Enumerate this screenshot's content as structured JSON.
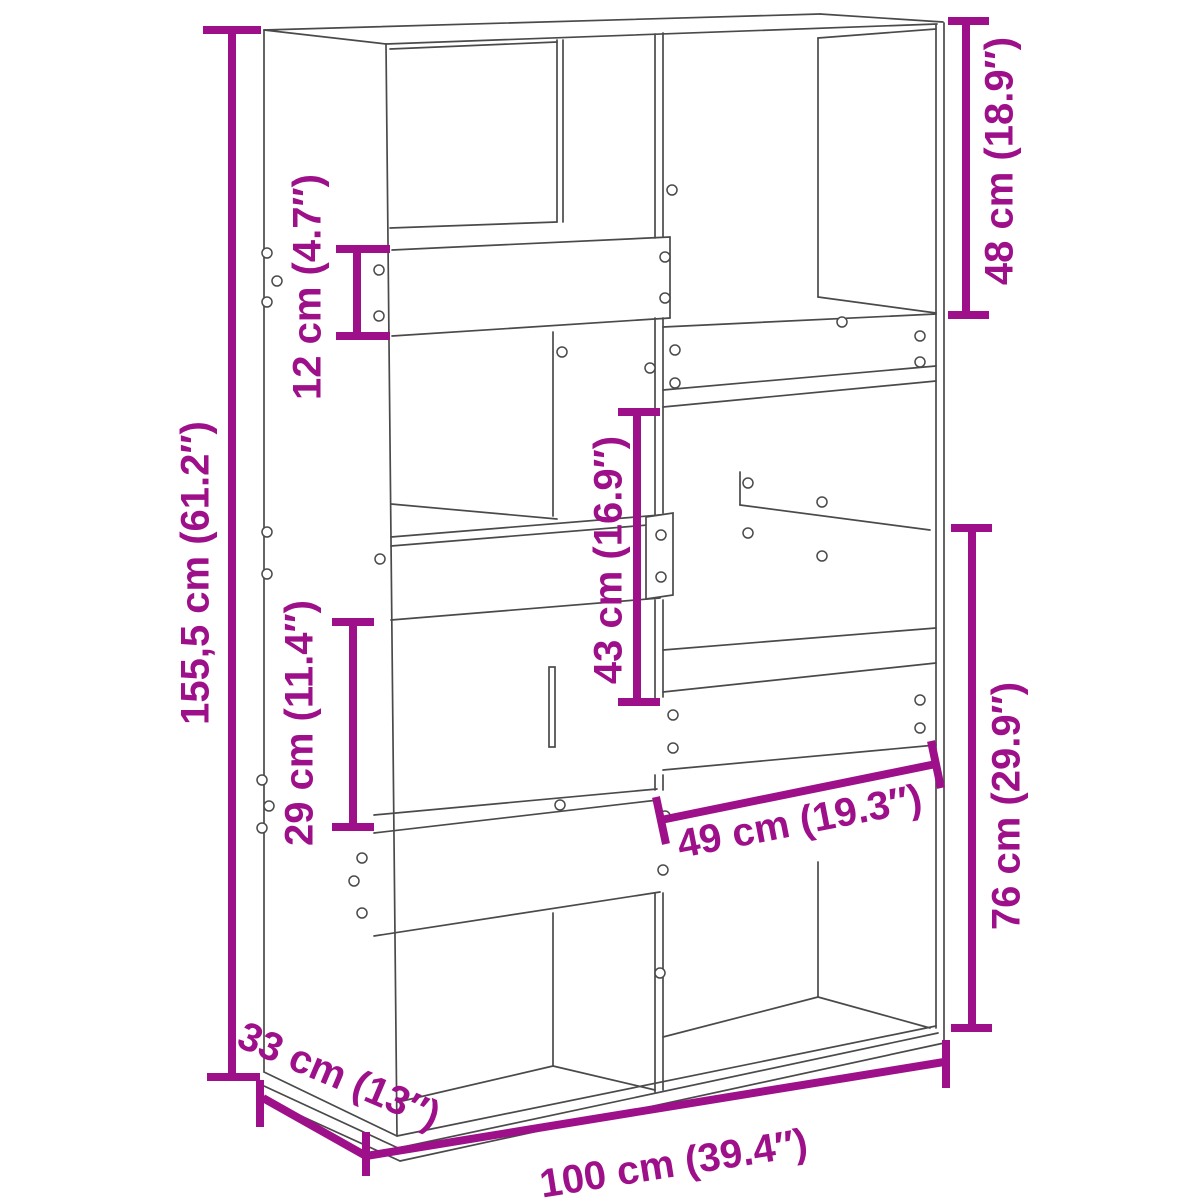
{
  "diagram": {
    "type": "furniture-dimension-diagram",
    "subject": "room divider bookcase line drawing",
    "background_color": "#ffffff",
    "line_color": "#4a4a4a",
    "accent_color": "#9D1089",
    "dimensions": {
      "total_height": {
        "label": "155,5 cm (61.2″)",
        "cm": "155,5",
        "inches": "61.2"
      },
      "riser_board_height": {
        "label": "12 cm (4.7″)",
        "cm": "12",
        "inches": "4.7"
      },
      "top_right_compartment": {
        "label": "48 cm (18.9″)",
        "cm": "48",
        "inches": "18.9"
      },
      "middle_compartment": {
        "label": "43 cm (16.9″)",
        "cm": "43",
        "inches": "16.9"
      },
      "lower_left_compartment": {
        "label": "29 cm (11.4″)",
        "cm": "29",
        "inches": "11.4"
      },
      "compartment_width": {
        "label": "49 cm (19.3″)",
        "cm": "49",
        "inches": "19.3"
      },
      "lower_right_section": {
        "label": "76 cm (29.9″)",
        "cm": "76",
        "inches": "29.9"
      },
      "depth": {
        "label": "33 cm (13″)",
        "cm": "33",
        "inches": "13"
      },
      "total_width": {
        "label": "100 cm (39.4″)",
        "cm": "100",
        "inches": "39.4"
      }
    }
  }
}
